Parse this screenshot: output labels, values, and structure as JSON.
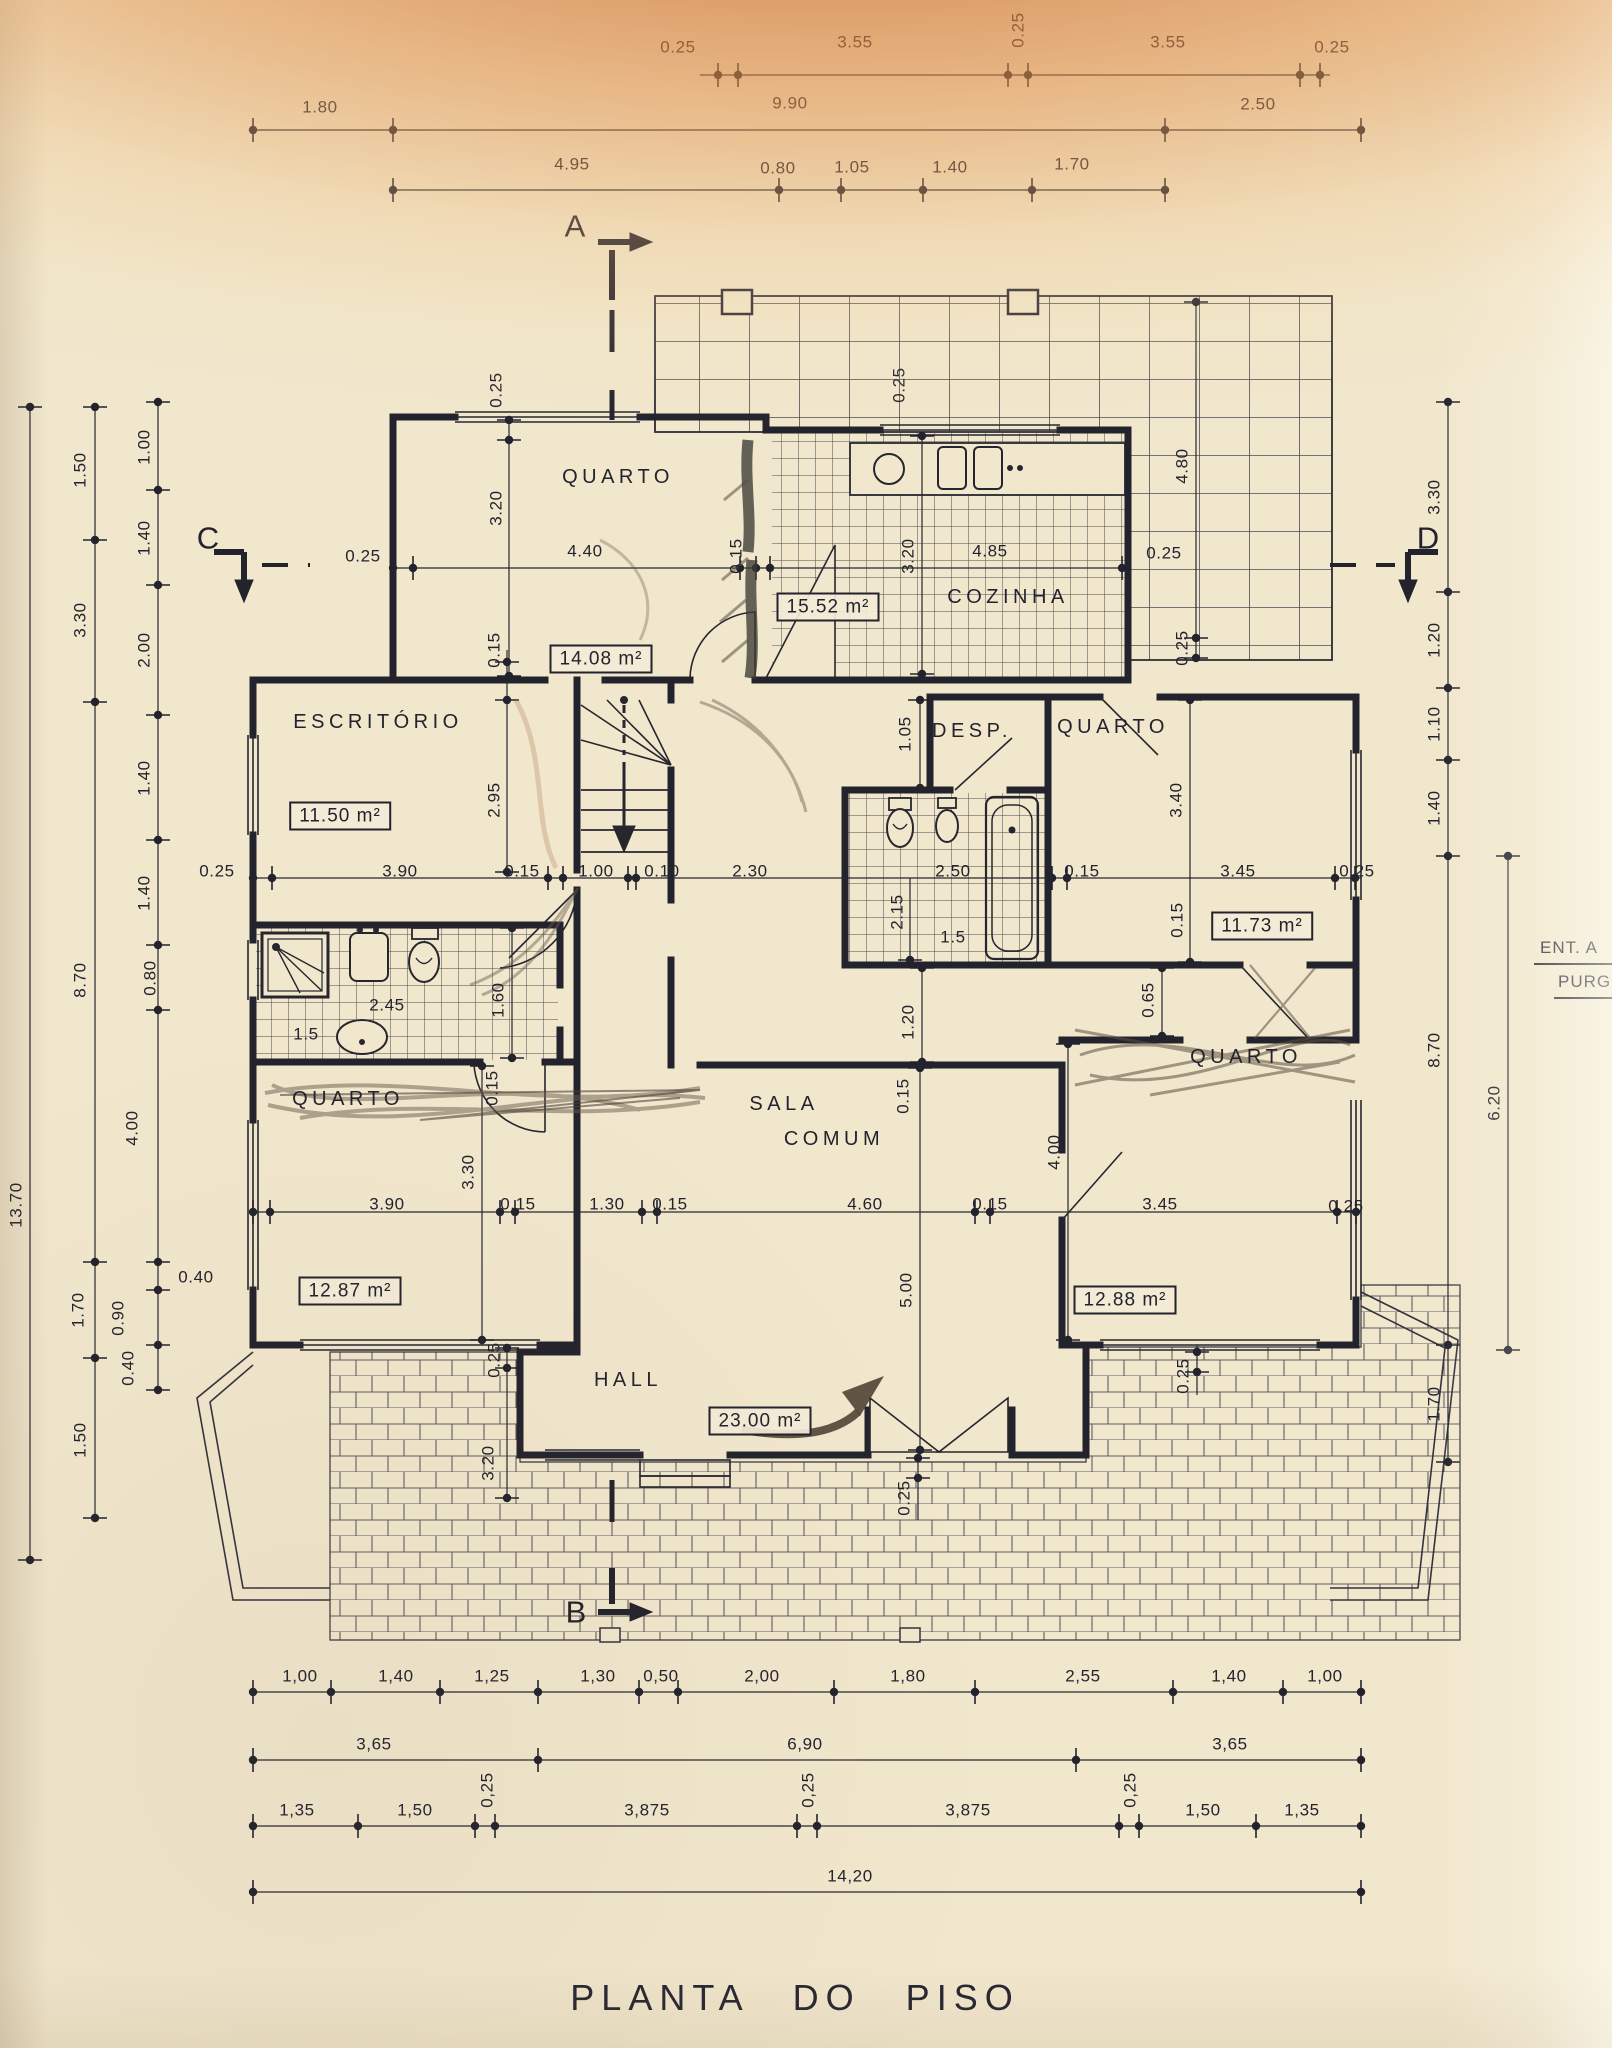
{
  "title": "PLANTA DO PISO",
  "section_markers": {
    "a": "A",
    "b": "B",
    "c": "C",
    "d": "D"
  },
  "side_note": {
    "line1": "ENT. A",
    "line2": "PURG"
  },
  "rooms": {
    "quarto_tl": "QUARTO",
    "cozinha": "COZINHA",
    "escritorio": "ESCRITÓRIO",
    "desp": "DESP.",
    "quarto_tr": "QUARTO",
    "quarto_bl": "QUARTO",
    "sala_1": "SALA",
    "sala_2": "COMUM",
    "quarto_br": "QUARTO",
    "hall": "HALL"
  },
  "areas": {
    "quarto_tl": "14.08 m²",
    "cozinha": "15.52 m²",
    "escritorio": "11.50 m²",
    "quarto_tr": "11.73 m²",
    "quarto_bl": "12.87 m²",
    "sala": "23.00 m²",
    "quarto_br": "12.88 m²"
  },
  "dims_top": [
    "0.25",
    "3.55",
    "0.25",
    "3.55",
    "0.25",
    "1.80",
    "9.90",
    "2.50",
    "4.95",
    "0.80",
    "1.05",
    "1.40",
    "1.70"
  ],
  "dims_left": [
    "13.70",
    "1.50",
    "3.30",
    "8.70",
    "1.70",
    "1.50",
    "1.00",
    "1.40",
    "2.00",
    "1.40",
    "1.40",
    "0.80",
    "4.00",
    "0.40",
    "0.90",
    "0.40"
  ],
  "dims_right": [
    "3.30",
    "1.20",
    "1.10",
    "1.40",
    "8.70",
    "6.20",
    "1.70",
    "4.80",
    "0.25"
  ],
  "dims_bottom": [
    "1,00",
    "1,40",
    "1,25",
    "1,30",
    "0,50",
    "2,00",
    "1,80",
    "2,55",
    "1,40",
    "1,00",
    "3,65",
    "6,90",
    "3,65",
    "1,35",
    "1,50",
    "0,25",
    "3,875",
    "0,25",
    "3,875",
    "0,25",
    "1,50",
    "1,35",
    "14,20"
  ],
  "dims_inner": [
    "0.25",
    "3.20",
    "0.25",
    "4.40",
    "0.15",
    "0.25",
    "3.20",
    "4.85",
    "0.25",
    "0.15",
    "2.95",
    "1.05",
    "3.40",
    "0.25",
    "3.90",
    "0.15",
    "1.00",
    "0.10",
    "2.30",
    "2.50",
    "0.15",
    "3.45",
    "0.25",
    "2.15",
    "1.5",
    "0.15",
    "2.45",
    "1.5",
    "1.60",
    "0.15",
    "1.20",
    "0.65",
    "0.15",
    "3.30",
    "4.00",
    "3.90",
    "0.15",
    "1.30",
    "0.15",
    "4.60",
    "0.15",
    "3.45",
    "0.25",
    "5.00",
    "0.25",
    "3.20",
    "0.25",
    "0.25"
  ],
  "ink_color": "#23232d",
  "paper_color": "#f1e7cd"
}
